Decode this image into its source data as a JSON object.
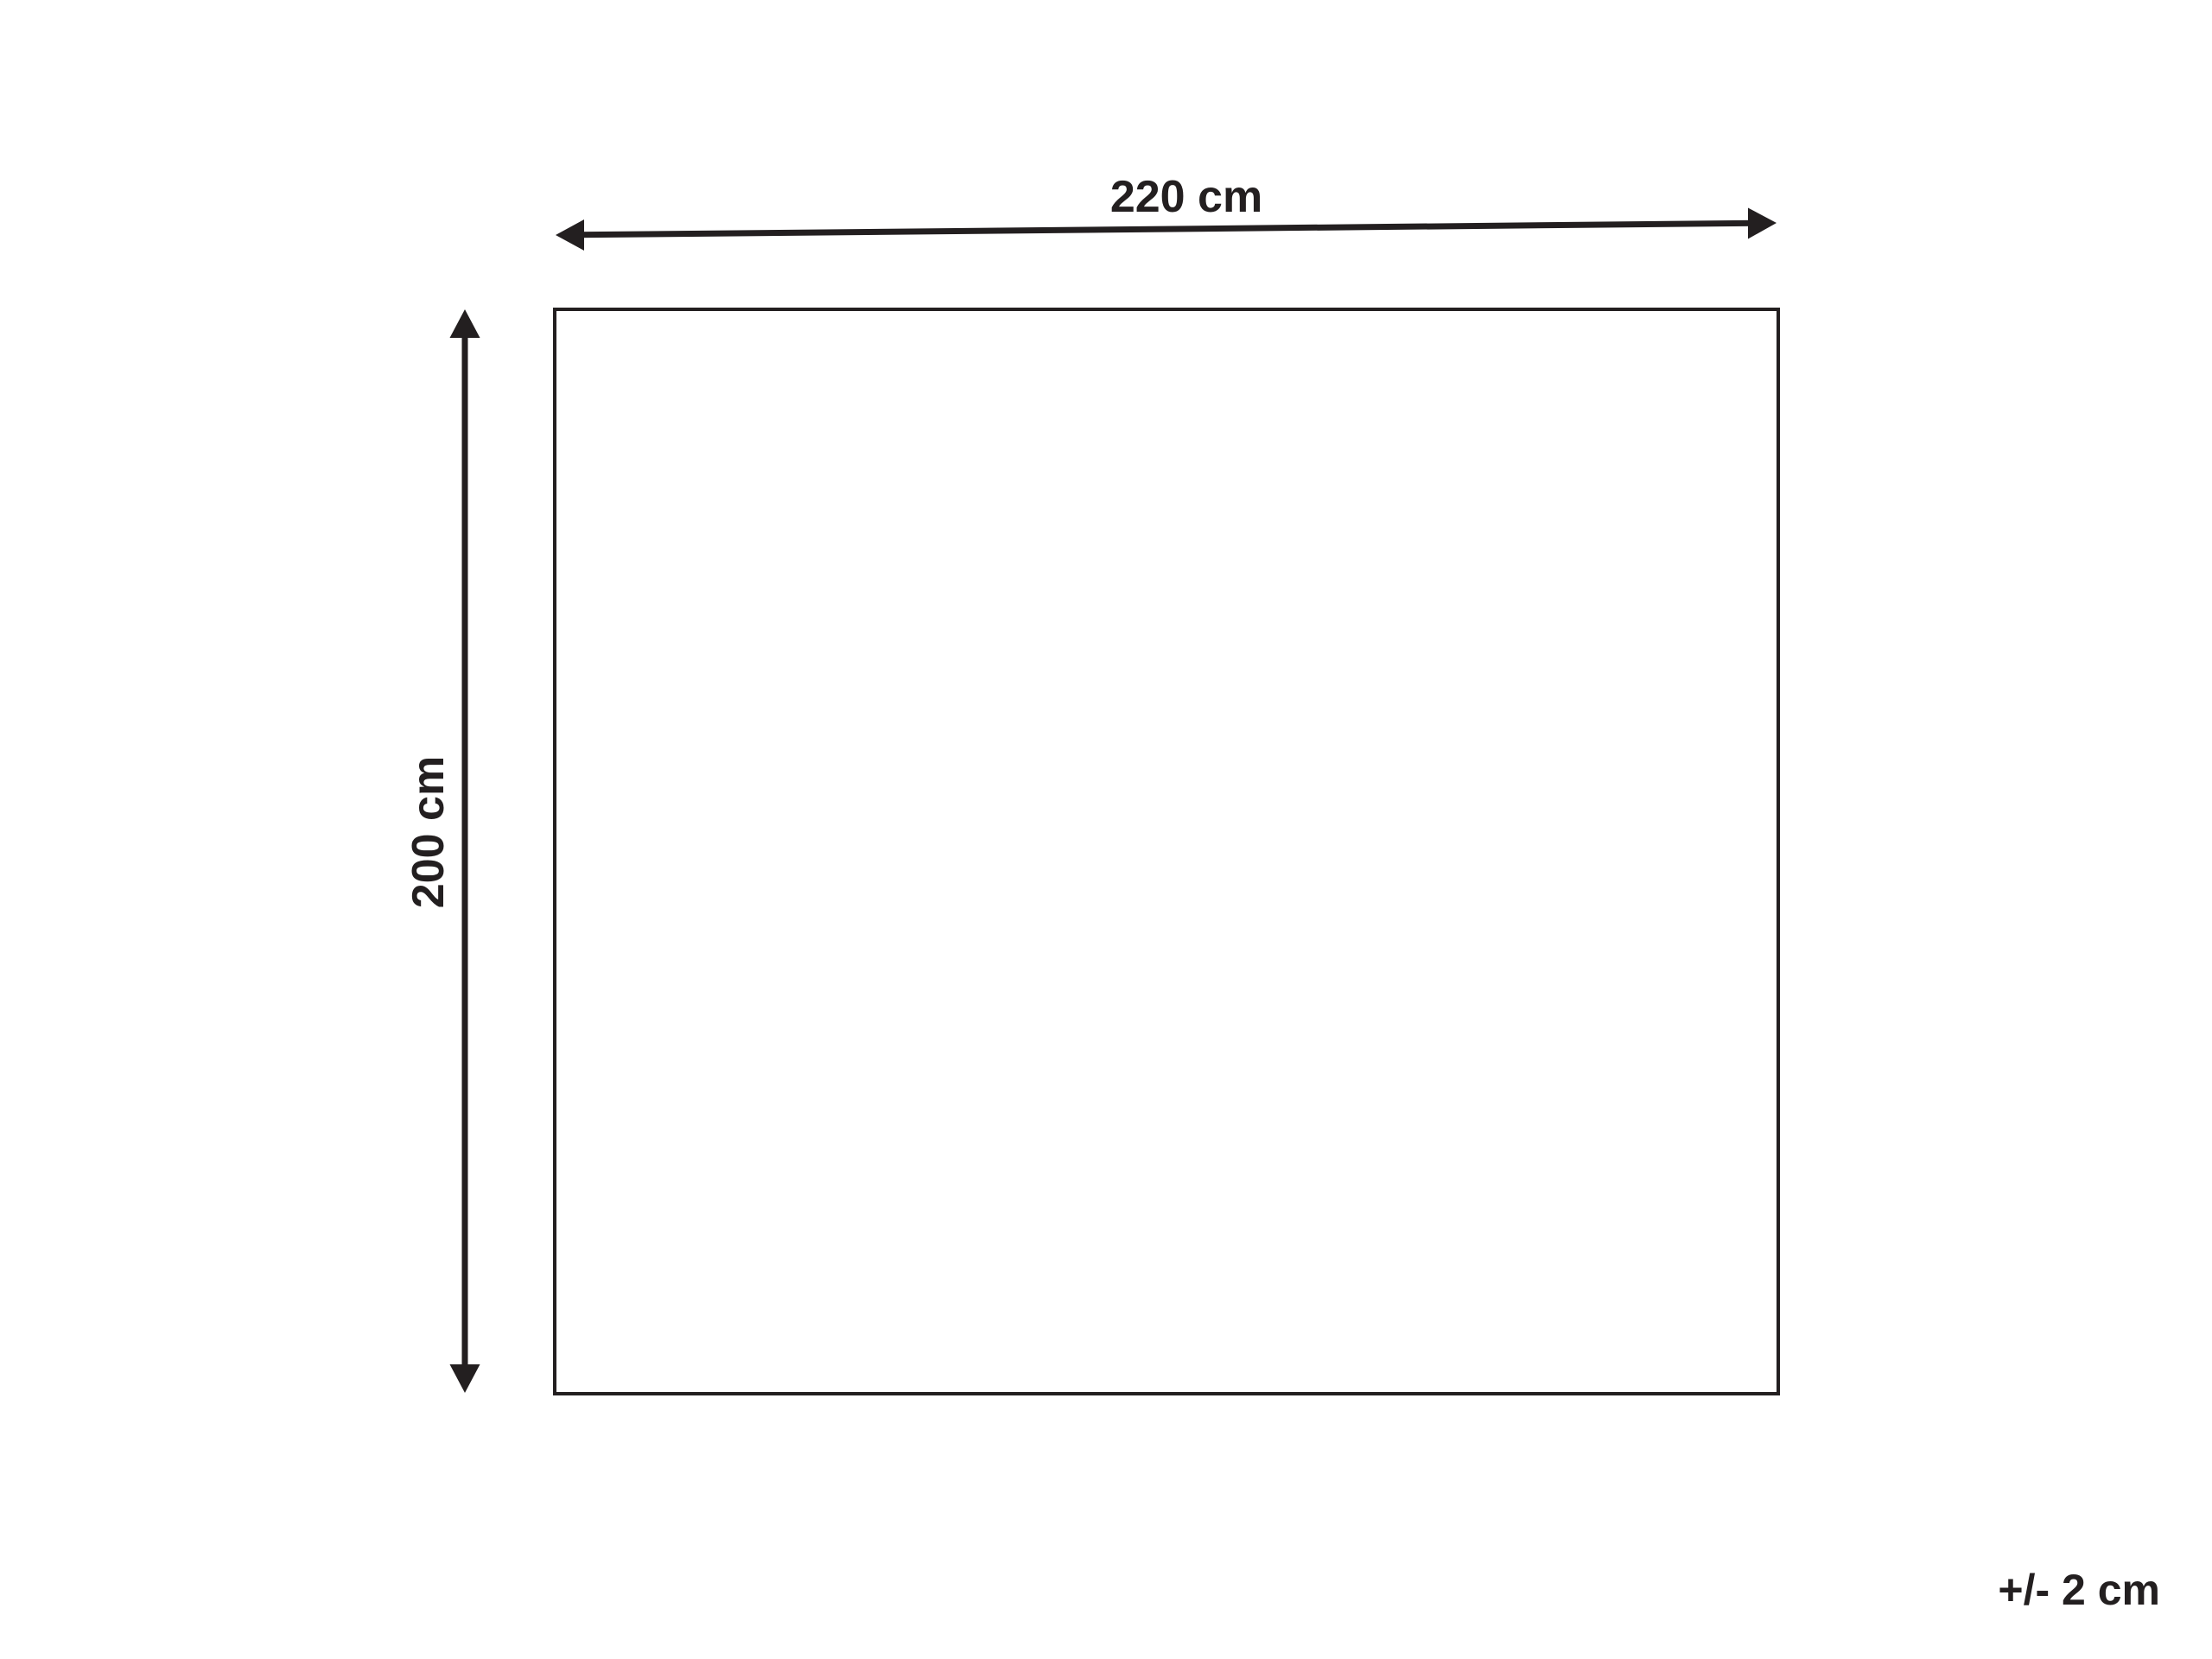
{
  "diagram": {
    "type": "product-dimension-diagram",
    "background_color": "#ffffff",
    "line_color": "#231f20",
    "width_dimension": {
      "label": "220 cm",
      "value_cm": 220
    },
    "height_dimension": {
      "label": "200 cm",
      "value_cm": 200
    },
    "tolerance": {
      "label": "+/- 2 cm",
      "value_cm": 2
    }
  }
}
